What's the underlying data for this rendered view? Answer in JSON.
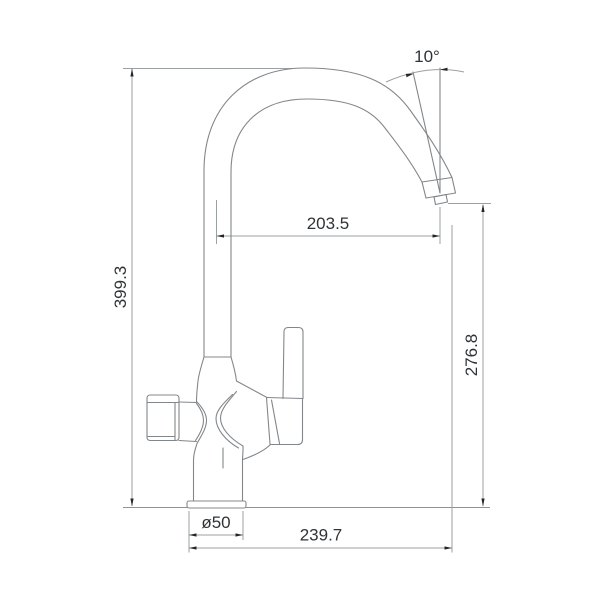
{
  "page": {
    "background_color": "#ffffff"
  },
  "drawing": {
    "subject": "kitchen faucet with high-arc gooseneck spout and side lever, technical side elevation with dimensions",
    "style": {
      "outline_color": "#83878a",
      "dimension_line_color": "#9ba0a3",
      "arrow_color": "#232527",
      "label_color": "#303336"
    },
    "dimensions": {
      "overall_height": "399.3",
      "spout_reach": "203.5",
      "outlet_height": "276.8",
      "total_reach": "239.7",
      "base_diameter": "ø50",
      "spout_angle": "10°"
    }
  }
}
